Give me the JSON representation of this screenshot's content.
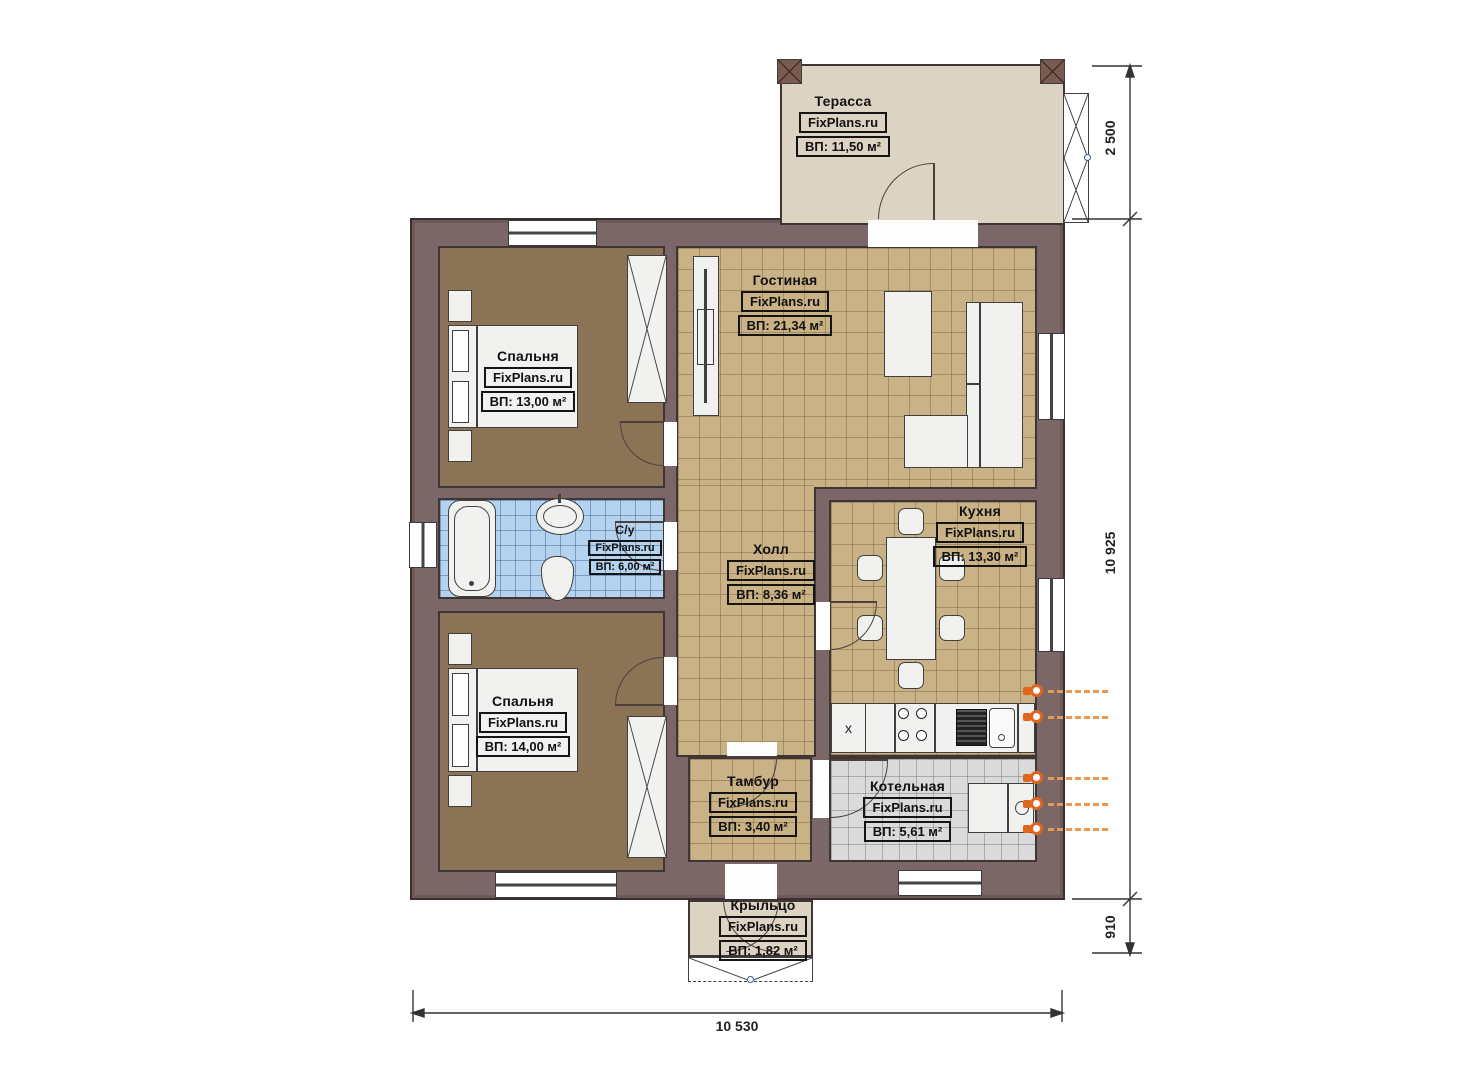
{
  "watermark": "FixPlans.ru",
  "rooms": [
    {
      "id": "terrace",
      "name": "Терасса",
      "area": "ВП: 11,50 м²"
    },
    {
      "id": "living",
      "name": "Гостиная",
      "area": "ВП: 21,34 м²"
    },
    {
      "id": "bedroom1",
      "name": "Спальня",
      "area": "ВП: 13,00 м²"
    },
    {
      "id": "bathroom",
      "name": "С/у",
      "area": "ВП: 6,00 м²"
    },
    {
      "id": "hall",
      "name": "Холл",
      "area": "ВП: 8,36 м²"
    },
    {
      "id": "kitchen",
      "name": "Кухня",
      "area": "ВП: 13,30 м²"
    },
    {
      "id": "bedroom2",
      "name": "Спальня",
      "area": "ВП: 14,00 м²"
    },
    {
      "id": "tambour",
      "name": "Тамбур",
      "area": "ВП: 3,40 м²"
    },
    {
      "id": "boiler",
      "name": "Котельная",
      "area": "ВП: 5,61 м²"
    },
    {
      "id": "porch",
      "name": "Крыльцо",
      "area": "ВП: 1,82 м²"
    }
  ],
  "dimensions": {
    "top_right": "2 500",
    "right": "10 925",
    "bottom_right": "910",
    "bottom": "10 530"
  },
  "kitchen_counter_mark": "x",
  "colors": {
    "wall": "#7c6768",
    "bedroom_floor": "#8b7355",
    "tile_floor": "#c9b285",
    "bathroom_tile": "#b5d2ef",
    "boiler_tile": "#dadada",
    "terrace_floor": "#ddd3c2",
    "radiator_accent": "#e0661e"
  }
}
